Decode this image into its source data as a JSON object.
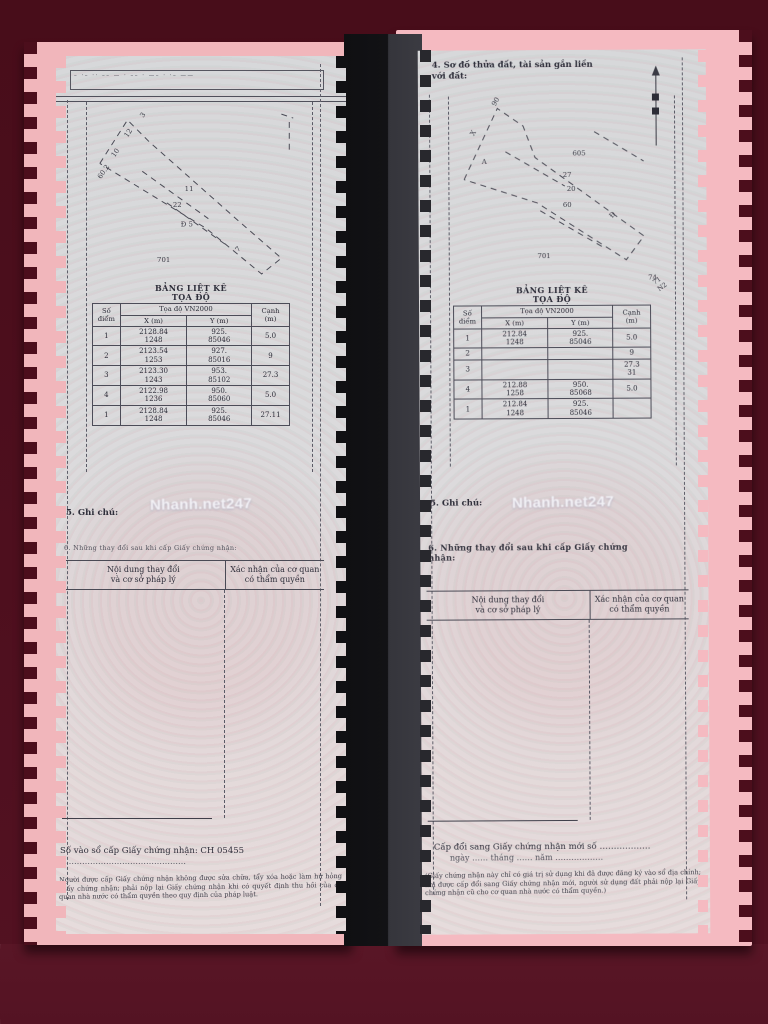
{
  "watermark": "Nhanh.net247",
  "colors": {
    "background": "#4c0e1c",
    "pink": "#f2b8bd",
    "page": "#d9dadd",
    "ink": "#34343f"
  },
  "left_page": {
    "top_strip_text": "– ·– ·· –– — · –– · —– · ·– ——",
    "sketch": {
      "lines": [
        "12,62 40,18 62,40 150,118 196,158 176,174 120,128 12,62",
        "55,70 122,118",
        "80,102 142,146",
        "196,12 208,16",
        "204,20 204,52"
      ],
      "labels": [
        {
          "t": "3",
          "x": 56,
          "y": 16,
          "r": -55
        },
        {
          "t": "12",
          "x": 40,
          "y": 36,
          "r": -55
        },
        {
          "t": "10",
          "x": 27,
          "y": 56,
          "r": -55
        },
        {
          "t": "60.2",
          "x": 13,
          "y": 78,
          "r": -55
        },
        {
          "t": "11",
          "x": 98,
          "y": 90,
          "r": 0
        },
        {
          "t": "22",
          "x": 86,
          "y": 106,
          "r": 0
        },
        {
          "t": "Đ 5",
          "x": 94,
          "y": 126,
          "r": 0
        },
        {
          "t": "701",
          "x": 70,
          "y": 162,
          "r": 0
        },
        {
          "t": "7",
          "x": 152,
          "y": 152,
          "r": -45
        }
      ]
    },
    "coord_table": {
      "title": "BẢNG LIỆT KÊ\nTỌA ĐỘ",
      "headers": {
        "point": "Số\nđiểm",
        "coords": "Tọa độ VN2000",
        "x": "X (m)",
        "y": "Y (m)",
        "edge": "Cạnh\n(m)"
      },
      "rows": [
        {
          "n": "1",
          "x": "2128.84\n1248",
          "y": "925.\n85046",
          "c": "5.0"
        },
        {
          "n": "2",
          "x": "2123.54\n1253",
          "y": "927.\n85016",
          "c": "9"
        },
        {
          "n": "3",
          "x": "2123.30\n1243",
          "y": "953.\n85102",
          "c": "27.3"
        },
        {
          "n": "4",
          "x": "2122.98\n1236",
          "y": "950.\n85060",
          "c": "5.0"
        },
        {
          "n": "1",
          "x": "2128.84\n1248",
          "y": "925.\n85046",
          "c": "27.11"
        }
      ]
    },
    "section5": "5. Ghi chú:",
    "section6": "6. Những thay đổi sau khi cấp Giấy chứng nhận:",
    "change_table": {
      "left": "Nội dung thay đổi\nvà cơ sở pháp lý",
      "right": "Xác nhận của cơ quan\ncó thẩm quyền"
    },
    "footer": {
      "line1": "Số vào sổ cấp Giấy chứng nhận: CH 05455",
      "line2": "………………………………………",
      "notes": "Người được cấp Giấy chứng nhận không được sửa chữa, tẩy xóa hoặc làm hư hỏng Giấy chứng nhận; phải nộp lại Giấy chứng nhận khi có quyết định thu hồi của cơ quan nhà nước có thẩm quyền theo quy định của pháp luật."
    }
  },
  "right_page": {
    "header4": "4. Sơ đồ thửa đất, tài sản gắn liền với đất:",
    "sketch": {
      "lines": [
        "18,88 52,16 78,34 90,66 200,146 182,170 92,112 18,88",
        "60,60 120,95",
        "95,120 160,158",
        "150,40 200,70"
      ],
      "labels": [
        {
          "t": "90",
          "x": 50,
          "y": 14,
          "r": -60
        },
        {
          "t": "X",
          "x": 28,
          "y": 44,
          "r": -60
        },
        {
          "t": "A",
          "x": 36,
          "y": 72,
          "r": 0
        },
        {
          "t": "605",
          "x": 128,
          "y": 64,
          "r": 0
        },
        {
          "t": "27",
          "x": 118,
          "y": 86,
          "r": 0
        },
        {
          "t": "20",
          "x": 122,
          "y": 100,
          "r": 0
        },
        {
          "t": "60",
          "x": 118,
          "y": 116,
          "r": 0
        },
        {
          "t": "Đ",
          "x": 168,
          "y": 128,
          "r": -50
        },
        {
          "t": "701",
          "x": 92,
          "y": 168,
          "r": 0
        },
        {
          "t": "74",
          "x": 204,
          "y": 190,
          "r": 0
        }
      ]
    },
    "corner_note": "71\nN2",
    "coord_table": {
      "title": "BẢNG LIỆT KÊ\nTỌA ĐỘ",
      "headers": {
        "point": "Số\nđiểm",
        "coords": "Tọa độ VN2000",
        "x": "X (m)",
        "y": "Y (m)",
        "edge": "Cạnh\n(m)"
      },
      "rows": [
        {
          "n": "1",
          "x": "212.84\n1248",
          "y": "925.\n85046",
          "c": "5.0"
        },
        {
          "n": "2",
          "x": "",
          "y": "",
          "c": "9"
        },
        {
          "n": "3",
          "x": "",
          "y": "",
          "c": "27.3\n31"
        },
        {
          "n": "4",
          "x": "212.88\n1258",
          "y": "950.\n85068",
          "c": "5.0"
        },
        {
          "n": "1",
          "x": "212.84\n1248",
          "y": "925.\n85046",
          "c": ""
        }
      ]
    },
    "section5": "5. Ghi chú:",
    "section6": "6. Những thay đổi sau khi cấp\nGiấy chứng nhận:",
    "change_table": {
      "left": "Nội dung thay đổi\nvà cơ sở pháp lý",
      "right": "Xác nhận của cơ quan\ncó thẩm quyền"
    },
    "footer": {
      "line1": "Cấp đổi sang Giấy chứng nhận mới số ………………",
      "line2": "ngày …… tháng …… năm ………………",
      "notes": "(Giấy chứng nhận này chỉ có giá trị sử dụng khi đã được đăng ký vào sổ địa chính; khi được cấp đổi sang Giấy chứng nhận mới, người sử dụng đất phải nộp lại Giấy chứng nhận cũ cho cơ quan nhà nước có thẩm quyền.)"
    }
  }
}
